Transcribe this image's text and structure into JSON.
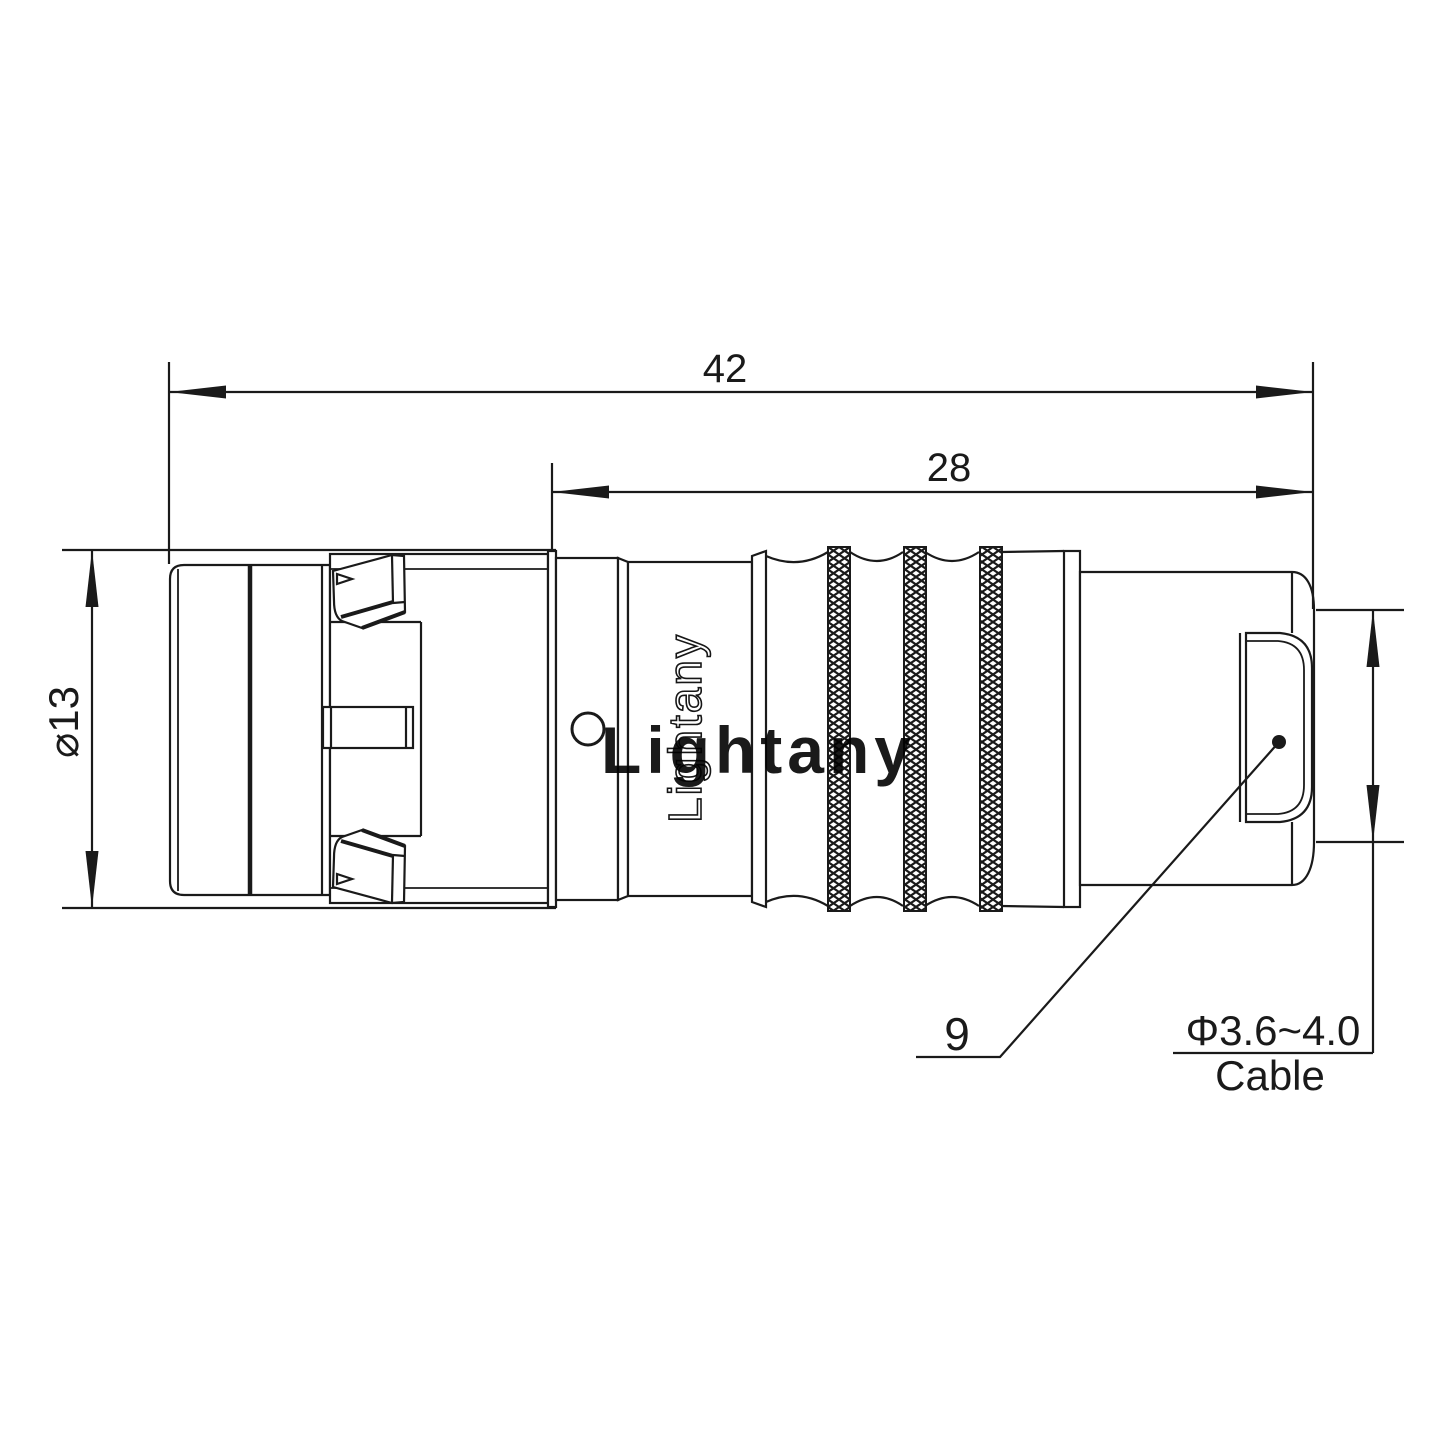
{
  "page": {
    "background": "#ffffff"
  },
  "drawing": {
    "type": "connector-technical-drawing",
    "line_color": "#1a1a1a",
    "watermark": {
      "text": "Lightany",
      "color": "#edb2b2"
    },
    "engraving": {
      "text": "Lightany"
    },
    "dimensions": {
      "overall_length": {
        "value": "42"
      },
      "body_length": {
        "value": "28"
      },
      "shell_diameter": {
        "value": "⌀13"
      },
      "rear_section": {
        "value": "9"
      },
      "cable": {
        "diameter": "Φ3.6~4.0",
        "label": "Cable"
      }
    }
  }
}
